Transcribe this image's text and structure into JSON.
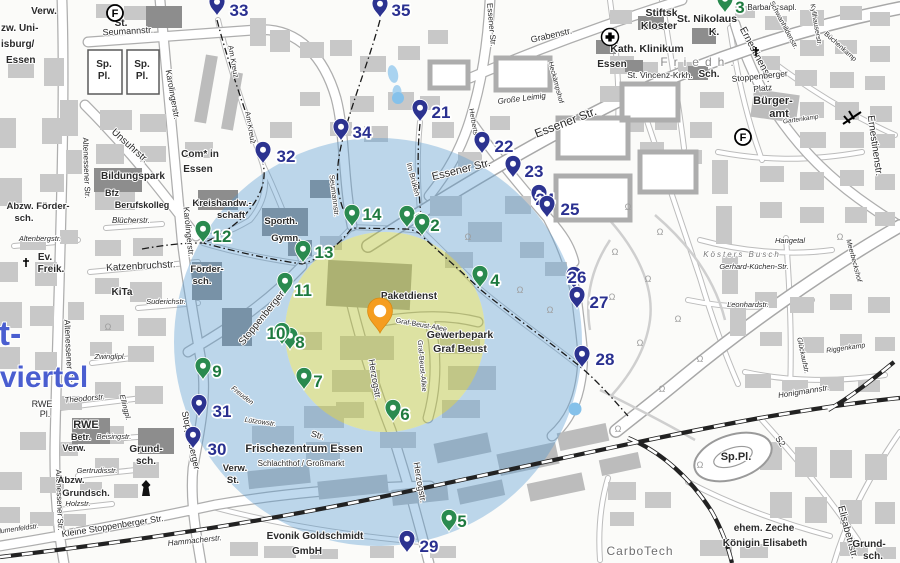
{
  "map": {
    "city_area_big_text": "viertel",
    "city_area_big_text_fragment": "t-",
    "tree_symbol": "Ω"
  },
  "overlays": {
    "outer_circle": {
      "cx": 378,
      "cy": 342,
      "r": 204,
      "color": "#569bd2",
      "opacity": 0.38
    },
    "inner_circle": {
      "cx": 385,
      "cy": 332,
      "r": 100,
      "color": "#b9c437",
      "opacity": 0.45
    },
    "dots": [
      {
        "x": 398,
        "y": 98,
        "r": 6
      },
      {
        "x": 575,
        "y": 409,
        "r": 6.5
      }
    ],
    "dot_color": "#85c1ea"
  },
  "main_pin": {
    "x": 380,
    "y": 333,
    "color": "#f59d20",
    "stroke": "#d98a10"
  },
  "markers": {
    "green_color": "#2a8a4f",
    "green_text_color": "#1f7a3f",
    "navy_color": "#2c3390",
    "navy_text_color": "#2a3090",
    "items": [
      {
        "id": 1,
        "k": "g",
        "x": 407,
        "y": 228,
        "lx": 419,
        "ly": 219
      },
      {
        "id": 2,
        "k": "g",
        "x": 422,
        "y": 236,
        "lx": 435,
        "ly": 225
      },
      {
        "id": 3,
        "k": "g",
        "x": 725,
        "y": 13,
        "lx": 740,
        "ly": 7
      },
      {
        "id": 4,
        "k": "g",
        "x": 480,
        "y": 288,
        "lx": 495,
        "ly": 280
      },
      {
        "id": 5,
        "k": "g",
        "x": 449,
        "y": 532,
        "lx": 462,
        "ly": 521
      },
      {
        "id": 6,
        "k": "g",
        "x": 393,
        "y": 422,
        "lx": 405,
        "ly": 414
      },
      {
        "id": 7,
        "k": "g",
        "x": 304,
        "y": 390,
        "lx": 318,
        "ly": 381
      },
      {
        "id": 8,
        "k": "g",
        "x": 290,
        "y": 350,
        "lx": 300,
        "ly": 342
      },
      {
        "id": 9,
        "k": "g",
        "x": 203,
        "y": 380,
        "lx": 217,
        "ly": 371
      },
      {
        "id": 10,
        "k": "g",
        "x": 282,
        "y": 345,
        "lx": 276,
        "ly": 333
      },
      {
        "id": 11,
        "k": "g",
        "x": 285,
        "y": 295,
        "lx": 303,
        "ly": 290
      },
      {
        "id": 12,
        "k": "g",
        "x": 203,
        "y": 243,
        "lx": 222,
        "ly": 236
      },
      {
        "id": 13,
        "k": "g",
        "x": 303,
        "y": 263,
        "lx": 324,
        "ly": 252
      },
      {
        "id": 14,
        "k": "g",
        "x": 352,
        "y": 227,
        "lx": 372,
        "ly": 214
      },
      {
        "id": 21,
        "k": "n",
        "x": 420,
        "y": 122,
        "lx": 441,
        "ly": 112
      },
      {
        "id": 22,
        "k": "n",
        "x": 482,
        "y": 154,
        "lx": 504,
        "ly": 146
      },
      {
        "id": 23,
        "k": "n",
        "x": 513,
        "y": 178,
        "lx": 534,
        "ly": 171
      },
      {
        "id": 24,
        "k": "n",
        "x": 539,
        "y": 207,
        "lx": 545,
        "ly": 199
      },
      {
        "id": 25,
        "k": "n",
        "x": 547,
        "y": 218,
        "lx": 570,
        "ly": 209
      },
      {
        "id": 26,
        "k": "n",
        "x": 574,
        "y": 289,
        "lx": 577,
        "ly": 277
      },
      {
        "id": 27,
        "k": "n",
        "x": 577,
        "y": 309,
        "lx": 599,
        "ly": 302
      },
      {
        "id": 28,
        "k": "n",
        "x": 582,
        "y": 368,
        "lx": 605,
        "ly": 359
      },
      {
        "id": 29,
        "k": "n",
        "x": 407,
        "y": 553,
        "lx": 429,
        "ly": 546
      },
      {
        "id": 30,
        "k": "n",
        "x": 193,
        "y": 449,
        "lx": 217,
        "ly": 449
      },
      {
        "id": 31,
        "k": "n",
        "x": 199,
        "y": 417,
        "lx": 222,
        "ly": 411
      },
      {
        "id": 32,
        "k": "n",
        "x": 263,
        "y": 164,
        "lx": 286,
        "ly": 156
      },
      {
        "id": 33,
        "k": "n",
        "x": 217,
        "y": 16,
        "lx": 239,
        "ly": 10
      },
      {
        "id": 34,
        "k": "n",
        "x": 341,
        "y": 141,
        "lx": 362,
        "ly": 132
      },
      {
        "id": 35,
        "k": "n",
        "x": 380,
        "y": 18,
        "lx": 401,
        "ly": 10
      }
    ]
  },
  "icons": [
    {
      "type": "circled-f",
      "label": "F",
      "x": 115,
      "y": 13
    },
    {
      "type": "circled-f",
      "label": "F",
      "x": 743,
      "y": 137
    },
    {
      "type": "hospital-cross",
      "x": 610,
      "y": 37
    },
    {
      "type": "church-cross",
      "x": 26,
      "y": 263
    },
    {
      "type": "church-cross",
      "x": 756,
      "y": 52
    },
    {
      "type": "tower",
      "x": 146,
      "y": 489
    },
    {
      "type": "rail-crossing",
      "x": 852,
      "y": 118
    }
  ],
  "tree_symbols": [
    [
      615,
      255
    ],
    [
      648,
      282
    ],
    [
      678,
      322
    ],
    [
      640,
      346
    ],
    [
      612,
      300
    ],
    [
      700,
      362
    ],
    [
      662,
      392
    ],
    [
      618,
      432
    ],
    [
      700,
      468
    ],
    [
      520,
      293
    ],
    [
      550,
      313
    ],
    [
      468,
      240
    ],
    [
      660,
      235
    ],
    [
      628,
      210
    ],
    [
      840,
      240
    ],
    [
      108,
      330
    ]
  ],
  "labels": [
    {
      "t": "Verw.",
      "x": 44,
      "y": 14,
      "s": 10,
      "b": 1
    },
    {
      "t": "St.",
      "x": 121,
      "y": 26,
      "s": 10,
      "b": 1
    },
    {
      "t": "Sp.",
      "x": 104,
      "y": 67,
      "s": 10,
      "b": 1
    },
    {
      "t": "Pl.",
      "x": 104,
      "y": 79,
      "s": 10,
      "b": 1
    },
    {
      "t": "Sp.",
      "x": 142,
      "y": 67,
      "s": 10,
      "b": 1
    },
    {
      "t": "Pl.",
      "x": 142,
      "y": 79,
      "s": 10,
      "b": 1
    },
    {
      "t": "Seumannstr.",
      "x": 128,
      "y": 34,
      "s": 9,
      "r": -3
    },
    {
      "t": "zw. Uni-",
      "x": 1,
      "y": 31,
      "s": 10,
      "b": 1,
      "a": "s"
    },
    {
      "t": "isburg/",
      "x": 1,
      "y": 47,
      "s": 10,
      "b": 1,
      "a": "s"
    },
    {
      "t": "Essen",
      "x": 6,
      "y": 63,
      "s": 10,
      "b": 1,
      "a": "s"
    },
    {
      "t": "Karolingerstr.",
      "x": 170,
      "y": 95,
      "s": 8.5,
      "r": 80
    },
    {
      "t": "Karolingerstr.",
      "x": 186,
      "y": 232,
      "s": 8.5,
      "r": 84
    },
    {
      "t": "Unsuhrstr.",
      "x": 128,
      "y": 148,
      "s": 10,
      "r": 42
    },
    {
      "t": "Com* in",
      "x": 200,
      "y": 157,
      "s": 10,
      "b": 1
    },
    {
      "t": "Essen",
      "x": 198,
      "y": 172,
      "s": 10,
      "b": 1
    },
    {
      "t": "Altenessener Str.",
      "x": 84,
      "y": 168,
      "s": 8,
      "r": 88
    },
    {
      "t": "Altenessener Str.",
      "x": 66,
      "y": 352,
      "s": 8.5,
      "r": 87
    },
    {
      "t": "Altenessener Str.",
      "x": 57,
      "y": 500,
      "s": 8,
      "r": 88
    },
    {
      "t": "Am Kreuz",
      "x": 231,
      "y": 62,
      "s": 7.5,
      "r": 80
    },
    {
      "t": "Am Kreuz",
      "x": 248,
      "y": 128,
      "s": 7.5,
      "r": 80
    },
    {
      "t": "Bildungspark",
      "x": 133,
      "y": 179,
      "s": 10,
      "b": 1
    },
    {
      "t": "Bfz",
      "x": 112,
      "y": 196,
      "s": 9,
      "b": 1
    },
    {
      "t": "Berufskolleg",
      "x": 142,
      "y": 208,
      "s": 9,
      "b": 1
    },
    {
      "t": "Kreishandw.-",
      "x": 222,
      "y": 206,
      "s": 9.5,
      "b": 1
    },
    {
      "t": "schaft",
      "x": 231,
      "y": 218,
      "s": 9.5,
      "b": 1
    },
    {
      "t": "Sporth.",
      "x": 281,
      "y": 224,
      "s": 9.5,
      "b": 1
    },
    {
      "t": "Gymn.",
      "x": 286,
      "y": 241,
      "s": 9.5,
      "b": 1
    },
    {
      "t": "Blücherstr.",
      "x": 131,
      "y": 223,
      "s": 8,
      "i": 1
    },
    {
      "t": "Katzenbruchstr.",
      "x": 141,
      "y": 269,
      "s": 10,
      "r": -3
    },
    {
      "t": "Ev.",
      "x": 45,
      "y": 260,
      "s": 10,
      "b": 1
    },
    {
      "t": "Freik.",
      "x": 51,
      "y": 272,
      "s": 10,
      "b": 1
    },
    {
      "t": "Abzw. Förder-",
      "x": 38,
      "y": 209,
      "s": 9.5,
      "b": 1
    },
    {
      "t": "sch.",
      "x": 24,
      "y": 221,
      "s": 9.5,
      "b": 1
    },
    {
      "t": "Altenbergstr.",
      "x": 40,
      "y": 241,
      "s": 7.5,
      "i": 1
    },
    {
      "t": "Förder-",
      "x": 207,
      "y": 272,
      "s": 9.5,
      "b": 1
    },
    {
      "t": "sch.",
      "x": 202,
      "y": 284,
      "s": 9.5,
      "b": 1
    },
    {
      "t": "KiTa",
      "x": 122,
      "y": 295,
      "s": 10,
      "b": 1
    },
    {
      "t": "Suderichstr.",
      "x": 166,
      "y": 304,
      "s": 7.5,
      "i": 1
    },
    {
      "t": "Stoppenberger",
      "x": 264,
      "y": 320,
      "s": 10,
      "r": -51
    },
    {
      "t": "Str.",
      "x": 317,
      "y": 438,
      "s": 9,
      "r": 15
    },
    {
      "t": "Stoppenberger",
      "x": 188,
      "y": 441,
      "s": 9,
      "r": 78
    },
    {
      "t": "Zwinglipl.",
      "x": 110,
      "y": 359,
      "s": 7.5,
      "i": 1
    },
    {
      "t": "Theodorstr.",
      "x": 85,
      "y": 401,
      "s": 8,
      "i": 1,
      "r": -5
    },
    {
      "t": "Ellingpl.",
      "x": 123,
      "y": 408,
      "s": 7.5,
      "i": 1,
      "r": 75
    },
    {
      "t": "RWE",
      "x": 42,
      "y": 407,
      "s": 9
    },
    {
      "t": "Pl.",
      "x": 45,
      "y": 417,
      "s": 9
    },
    {
      "t": "RWE",
      "x": 86,
      "y": 428,
      "s": 11,
      "b": 1
    },
    {
      "t": "Betr.",
      "x": 81,
      "y": 440,
      "s": 9,
      "b": 1
    },
    {
      "t": "Verw.",
      "x": 74,
      "y": 451,
      "s": 9,
      "b": 1
    },
    {
      "t": "Beisingstr.",
      "x": 114,
      "y": 439,
      "s": 7.5,
      "i": 1
    },
    {
      "t": "Grund-",
      "x": 146,
      "y": 452,
      "s": 10,
      "b": 1
    },
    {
      "t": "sch.",
      "x": 146,
      "y": 464,
      "s": 10,
      "b": 1
    },
    {
      "t": "Gertrudisstr.",
      "x": 97,
      "y": 473,
      "s": 7.5,
      "i": 1
    },
    {
      "t": "Abzw.",
      "x": 71,
      "y": 483,
      "s": 9.5,
      "b": 1
    },
    {
      "t": "Grundsch.",
      "x": 86,
      "y": 496,
      "s": 9.5,
      "b": 1
    },
    {
      "t": "Holzstr.",
      "x": 78,
      "y": 506,
      "s": 7.5,
      "i": 1
    },
    {
      "t": "Kleine Stoppenberger Str.",
      "x": 113,
      "y": 529,
      "s": 9,
      "r": -9
    },
    {
      "t": "Blumenfeldstr.",
      "x": 17,
      "y": 531,
      "s": 7,
      "i": 1,
      "r": -8
    },
    {
      "t": "Hammacherstr.",
      "x": 195,
      "y": 543,
      "s": 8,
      "i": 1,
      "r": -6
    },
    {
      "t": "Frischezentrum Essen",
      "x": 304,
      "y": 452,
      "s": 11,
      "b": 1
    },
    {
      "t": "Schlachthof / Großmarkt",
      "x": 301,
      "y": 466,
      "s": 8
    },
    {
      "t": "Verw.",
      "x": 235,
      "y": 471,
      "s": 9.5,
      "b": 1
    },
    {
      "t": "St.",
      "x": 233,
      "y": 483,
      "s": 9.5,
      "b": 1
    },
    {
      "t": "Evonik Goldschmidt",
      "x": 315,
      "y": 539,
      "s": 10,
      "b": 1
    },
    {
      "t": "GmbH",
      "x": 307,
      "y": 554,
      "s": 10,
      "b": 1
    },
    {
      "t": "Herzogstr.",
      "x": 372,
      "y": 380,
      "s": 9,
      "r": 80
    },
    {
      "t": "Herzogstr.",
      "x": 417,
      "y": 483,
      "s": 9,
      "r": 80
    },
    {
      "t": "Graf-Beust-Allee",
      "x": 421,
      "y": 327,
      "s": 7,
      "r": 10
    },
    {
      "t": "Graf-Beust-Allee",
      "x": 420,
      "y": 366,
      "s": 7,
      "r": 85
    },
    {
      "t": "Paketdienst",
      "x": 409,
      "y": 299,
      "s": 10,
      "b": 1
    },
    {
      "t": "Gewerbepark",
      "x": 460,
      "y": 338,
      "s": 10.5,
      "b": 1
    },
    {
      "t": "Graf Beust",
      "x": 460,
      "y": 352,
      "s": 10.5,
      "b": 1
    },
    {
      "t": "Seumannstr.",
      "x": 332,
      "y": 196,
      "s": 7.5,
      "r": 83
    },
    {
      "t": "Im Brüken",
      "x": 411,
      "y": 180,
      "s": 7.5,
      "r": 75
    },
    {
      "t": "Essener  Str.",
      "x": 567,
      "y": 126,
      "s": 12,
      "r": -21
    },
    {
      "t": "Essener  Str.",
      "x": 462,
      "y": 173,
      "s": 11,
      "r": -14
    },
    {
      "t": "Essener Str.",
      "x": 489,
      "y": 25,
      "s": 8,
      "r": 85
    },
    {
      "t": "Grabenstr.",
      "x": 552,
      "y": 38,
      "s": 9,
      "r": -13
    },
    {
      "t": "Große Leimig",
      "x": 522,
      "y": 101,
      "s": 8,
      "i": 1,
      "r": -7
    },
    {
      "t": "Herbertstr.",
      "x": 472,
      "y": 125,
      "s": 7,
      "r": 80
    },
    {
      "t": "Heckämpshof",
      "x": 554,
      "y": 83,
      "s": 7,
      "r": 75
    },
    {
      "t": "Kath. Klinikum",
      "x": 647,
      "y": 52,
      "s": 10.5,
      "b": 1
    },
    {
      "t": "Essen",
      "x": 612,
      "y": 67,
      "s": 10,
      "b": 1
    },
    {
      "t": "Friedh.",
      "x": 700,
      "y": 66,
      "s": 12,
      "c": "#8a8a8a",
      "ls": 6
    },
    {
      "t": "St. Vincenz-Krkh.",
      "x": 660,
      "y": 78,
      "s": 8.5
    },
    {
      "t": "Stiftsk.",
      "x": 663,
      "y": 16,
      "s": 10.5,
      "b": 1
    },
    {
      "t": "Kloster",
      "x": 659,
      "y": 29,
      "s": 10.5,
      "b": 1
    },
    {
      "t": "St. Nikolaus",
      "x": 707,
      "y": 22,
      "s": 10.5,
      "b": 1
    },
    {
      "t": "K.",
      "x": 714,
      "y": 35,
      "s": 10.5,
      "b": 1
    },
    {
      "t": "Barbarossapl.",
      "x": 772,
      "y": 10,
      "s": 8
    },
    {
      "t": "Schwanhildenstr.",
      "x": 782,
      "y": 26,
      "s": 7,
      "r": 62
    },
    {
      "t": "Kyllhauserstr.",
      "x": 814,
      "y": 25,
      "s": 7,
      "r": 80
    },
    {
      "t": "Büchenkamp",
      "x": 839,
      "y": 48,
      "s": 7,
      "r": 42
    },
    {
      "t": "Ernestinenstr.",
      "x": 754,
      "y": 56,
      "s": 10,
      "r": 62
    },
    {
      "t": "Stoppenberger",
      "x": 760,
      "y": 79,
      "s": 8.5,
      "r": -6
    },
    {
      "t": "Platz",
      "x": 763,
      "y": 91,
      "s": 8.5,
      "r": -6
    },
    {
      "t": "Bürger-",
      "x": 773,
      "y": 104,
      "s": 11,
      "b": 1
    },
    {
      "t": "amt",
      "x": 779,
      "y": 117,
      "s": 11,
      "b": 1
    },
    {
      "t": "Gartenkamp",
      "x": 801,
      "y": 121,
      "s": 6.5,
      "i": 1,
      "r": -8
    },
    {
      "t": "Sch.",
      "x": 709,
      "y": 77,
      "s": 10,
      "b": 1
    },
    {
      "t": "Ernestinenstr.",
      "x": 872,
      "y": 146,
      "s": 10,
      "r": 82
    },
    {
      "t": "Hangetal",
      "x": 790,
      "y": 243,
      "s": 7.5,
      "i": 1
    },
    {
      "t": "Kösters Busch",
      "x": 742,
      "y": 257,
      "s": 8,
      "i": 1,
      "c": "#777777",
      "ls": 2
    },
    {
      "t": "Gerhard-Küchen-Str.",
      "x": 754,
      "y": 269,
      "s": 7.5,
      "i": 1
    },
    {
      "t": "Leonhardstr.",
      "x": 748,
      "y": 307,
      "s": 7.5,
      "i": 1
    },
    {
      "t": "Glückaufstr.",
      "x": 801,
      "y": 356,
      "s": 7,
      "i": 1,
      "r": 78
    },
    {
      "t": "Riggenkamp",
      "x": 846,
      "y": 350,
      "s": 7,
      "i": 1,
      "r": -8
    },
    {
      "t": "Meerbeckshof",
      "x": 852,
      "y": 261,
      "s": 7,
      "i": 1,
      "r": 75
    },
    {
      "t": "Honigmannstr.",
      "x": 804,
      "y": 394,
      "s": 8,
      "i": 1,
      "r": -9
    },
    {
      "t": "Sp.Pl.",
      "x": 736,
      "y": 460,
      "s": 11,
      "b": 1
    },
    {
      "t": "S2",
      "x": 778,
      "y": 443,
      "s": 9,
      "r": 55
    },
    {
      "t": "ehem. Zeche",
      "x": 764,
      "y": 531,
      "s": 10,
      "b": 1
    },
    {
      "t": "Königin Elisabeth",
      "x": 765,
      "y": 546,
      "s": 10,
      "b": 1
    },
    {
      "t": "CarboTech",
      "x": 640,
      "y": 555,
      "s": 12,
      "c": "#6e6e6e",
      "ls": 1
    },
    {
      "t": "Elisabethstr.",
      "x": 845,
      "y": 533,
      "s": 10,
      "r": 75
    },
    {
      "t": "Grund-",
      "x": 869,
      "y": 547,
      "s": 10,
      "b": 1
    },
    {
      "t": "sch.",
      "x": 873,
      "y": 559,
      "s": 10,
      "b": 1
    },
    {
      "t": "viertel",
      "x": 44,
      "y": 387,
      "s": 30,
      "b": 1,
      "c": "#4a5ed0"
    },
    {
      "t": "t-",
      "x": 10,
      "y": 345,
      "s": 34,
      "b": 1,
      "c": "#4a5ed0"
    },
    {
      "t": "Lützowstr.",
      "x": 260,
      "y": 424,
      "s": 7,
      "i": 1,
      "r": 8
    },
    {
      "t": "Freuden",
      "x": 241,
      "y": 397,
      "s": 7,
      "i": 1,
      "r": 38
    }
  ]
}
